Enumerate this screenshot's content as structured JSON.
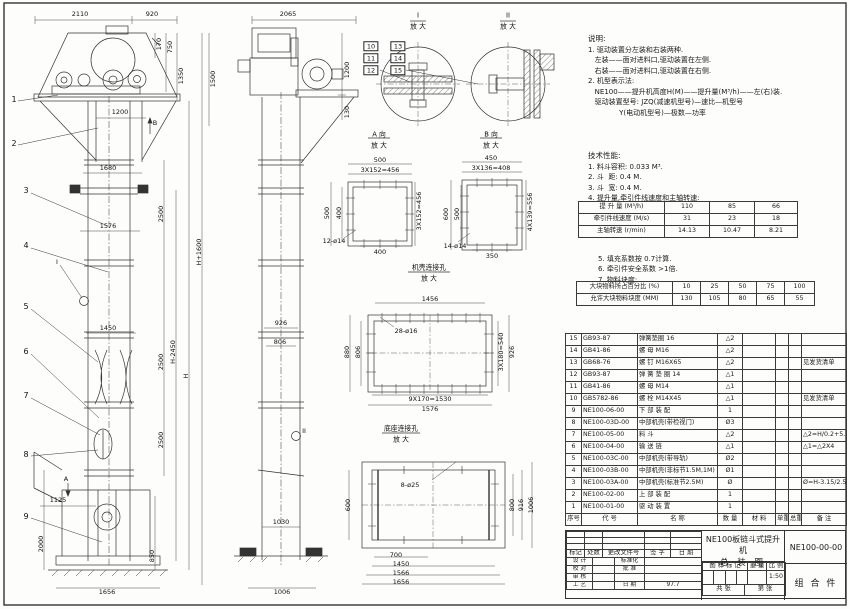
{
  "doc": {
    "type": "engineering-assembly-drawing",
    "product": "NE100板链斗式提升机",
    "drawing_title_line1": "NE100板链斗式提升机",
    "drawing_title_line2": "总  装  图",
    "drawing_number": "NE100-00-00",
    "part_class": "组 合 件",
    "scale": "1:50",
    "date": "97.7"
  },
  "notes": {
    "title": "说明:",
    "lines": [
      "1. 驱动装置分左装和右装两种.",
      "   左装——面对进料口,驱动装置在左侧.",
      "   右装——面对进料口,驱动装置在右侧.",
      "2. 机型表示法:",
      "   NE100——提升机高度H(M)——提升量(M³/h)——左(右)装.",
      "   驱动装置型号: JZQ(减速机型号)—速比—机型号",
      "              Y(电动机型号)—极数—功率"
    ]
  },
  "tech": {
    "title": "技术性能:",
    "lines": [
      "1. 料斗容积: 0.033 M³.",
      "2. 斗  距: 0.4 M.",
      "3. 斗  宽: 0.4 M.",
      "4. 提升量,牵引件线速度和主轴转速:"
    ],
    "notes2": [
      "5. 填充系数按 0.7计算.",
      "6. 牵引件安全系数 >1倍.",
      "7. 物料块度:"
    ]
  },
  "perf_table": {
    "rows": [
      [
        "提 升 量  (M³/h)",
        "110",
        "85",
        "66"
      ],
      [
        "牵引件线速度 (M/s)",
        "31",
        "23",
        "18"
      ],
      [
        "主轴转速 (r/min)",
        "14.13",
        "10.47",
        "8.21"
      ]
    ]
  },
  "lump_table": {
    "rows": [
      [
        "大块物料所占百分比 (%)",
        "10",
        "25",
        "50",
        "75",
        "100"
      ],
      [
        "允许大块物料块度 (MM)",
        "130",
        "105",
        "80",
        "65",
        "55"
      ]
    ]
  },
  "bom": {
    "headers": [
      "序号",
      "代  号",
      "名  称",
      "数 量",
      "材  料",
      "单重",
      "总重",
      "备  注"
    ],
    "rows": [
      [
        "15",
        "GB93-87",
        "弹簧垫圈  16",
        "△2",
        "",
        "",
        "",
        ""
      ],
      [
        "14",
        "GB41-86",
        "螺  母  M16",
        "△2",
        "",
        "",
        "",
        ""
      ],
      [
        "13",
        "GB68-76",
        "螺  钉  M16X65",
        "△2",
        "",
        "",
        "",
        "见发货清单"
      ],
      [
        "12",
        "GB93-87",
        "弹 簧 垫 圈  14",
        "△1",
        "",
        "",
        "",
        ""
      ],
      [
        "11",
        "GB41-86",
        "螺  母  M14",
        "△1",
        "",
        "",
        "",
        ""
      ],
      [
        "10",
        "GB5782-86",
        "螺  栓  M14X45",
        "△1",
        "",
        "",
        "",
        "见发货清单"
      ],
      [
        "9",
        "NE100-06-00",
        "下 部 装 配",
        "1",
        "",
        "",
        "",
        ""
      ],
      [
        "8",
        "NE100-03D-00",
        "中部机壳(带检视门)",
        "Ø3",
        "",
        "",
        "",
        ""
      ],
      [
        "7",
        "NE100-05-00",
        "料  斗",
        "△2",
        "",
        "",
        "",
        "△2=H/0.2+5.75"
      ],
      [
        "6",
        "NE100-04-00",
        "输 送 链",
        "△1",
        "",
        "",
        "",
        "△1=△2X4"
      ],
      [
        "5",
        "NE100-03C-00",
        "中部机壳(带导轨)",
        "Ø2",
        "",
        "",
        "",
        ""
      ],
      [
        "4",
        "NE100-03B-00",
        "中部机壳(非标节1.5M,1M)",
        "Ø1",
        "",
        "",
        "",
        ""
      ],
      [
        "3",
        "NE100-03A-00",
        "中部机壳(标准节2.5M)",
        "Ø",
        "",
        "",
        "",
        "Ø=H-3.15/2.5"
      ],
      [
        "2",
        "NE100-02-00",
        "上 部 装 配",
        "1",
        "",
        "",
        "",
        ""
      ],
      [
        "1",
        "NE100-01-00",
        "驱 动 装 置",
        "1",
        "",
        "",
        "",
        ""
      ]
    ]
  },
  "title_block": {
    "change_header": [
      "标记",
      "处数",
      "更改文件号",
      "签 字",
      "日 期"
    ],
    "sign_rows": [
      [
        "设 计",
        "",
        "标准化",
        ""
      ],
      [
        "校 对",
        "",
        "批 准",
        ""
      ],
      [
        "审 核",
        "",
        "",
        ""
      ],
      [
        "工 艺",
        "",
        "日 期",
        "97.7"
      ]
    ],
    "mark_header": [
      "图 样 标 记",
      "重 量",
      "比 例"
    ],
    "scale_value": "1:50",
    "sheet_left": "共  张",
    "sheet_right": "第  张"
  },
  "view_titles": {
    "detail1": "I",
    "detail2": "II",
    "enlarge": "放 大",
    "viewA": "A 向",
    "viewB": "B 向",
    "casing_holes": "机壳连接孔",
    "base_holes": "底座连接孔"
  },
  "labels": [
    {
      "t": "2110",
      "x": 80,
      "y": 14
    },
    {
      "t": "920",
      "x": 152,
      "y": 14
    },
    {
      "t": "170",
      "x": 159,
      "y": 44,
      "c": "v"
    },
    {
      "t": "750",
      "x": 170,
      "y": 47,
      "c": "v"
    },
    {
      "t": "1350",
      "x": 181,
      "y": 76,
      "c": "v"
    },
    {
      "t": "1500",
      "x": 213,
      "y": 79,
      "c": "v"
    },
    {
      "t": "1200",
      "x": 120,
      "y": 112
    },
    {
      "t": "B",
      "x": 155,
      "y": 123
    },
    {
      "t": "1680",
      "x": 108,
      "y": 168
    },
    {
      "t": "1576",
      "x": 108,
      "y": 226
    },
    {
      "t": "2500",
      "x": 161,
      "y": 214,
      "c": "v"
    },
    {
      "t": "2500",
      "x": 161,
      "y": 362,
      "c": "v"
    },
    {
      "t": "2500",
      "x": 161,
      "y": 440,
      "c": "v"
    },
    {
      "t": "H-2450",
      "x": 173,
      "y": 352,
      "c": "v"
    },
    {
      "t": "H",
      "x": 186,
      "y": 376,
      "c": "v"
    },
    {
      "t": "H+1600",
      "x": 199,
      "y": 252,
      "c": "v"
    },
    {
      "t": "1450",
      "x": 108,
      "y": 328
    },
    {
      "t": "1125",
      "x": 58,
      "y": 500
    },
    {
      "t": "2000",
      "x": 41,
      "y": 544,
      "c": "v"
    },
    {
      "t": "850",
      "x": 152,
      "y": 556,
      "c": "v"
    },
    {
      "t": "A",
      "x": 66,
      "y": 479
    },
    {
      "t": "1656",
      "x": 107,
      "y": 592
    },
    {
      "t": "I",
      "x": 57,
      "y": 262
    },
    {
      "t": "II",
      "x": 304,
      "y": 431
    },
    {
      "t": "2065",
      "x": 288,
      "y": 14
    },
    {
      "t": "1200",
      "x": 347,
      "y": 70,
      "c": "v"
    },
    {
      "t": "130",
      "x": 347,
      "y": 112,
      "c": "v"
    },
    {
      "t": "926",
      "x": 281,
      "y": 323
    },
    {
      "t": "806",
      "x": 280,
      "y": 342
    },
    {
      "t": "1030",
      "x": 281,
      "y": 522
    },
    {
      "t": "1006",
      "x": 282,
      "y": 592
    },
    {
      "t": "500",
      "x": 380,
      "y": 160
    },
    {
      "t": "3X152=456",
      "x": 380,
      "y": 170
    },
    {
      "t": "500",
      "x": 327,
      "y": 213,
      "c": "v"
    },
    {
      "t": "400",
      "x": 339,
      "y": 213,
      "c": "v"
    },
    {
      "t": "3X152=456",
      "x": 419,
      "y": 211,
      "c": "v"
    },
    {
      "t": "12-ø14",
      "x": 334,
      "y": 241
    },
    {
      "t": "400",
      "x": 380,
      "y": 252
    },
    {
      "t": "450",
      "x": 491,
      "y": 158
    },
    {
      "t": "3X136=408",
      "x": 491,
      "y": 168
    },
    {
      "t": "600",
      "x": 446,
      "y": 214,
      "c": "v"
    },
    {
      "t": "500",
      "x": 457,
      "y": 214,
      "c": "v"
    },
    {
      "t": "4X139=556",
      "x": 530,
      "y": 212,
      "c": "v"
    },
    {
      "t": "14-ø14",
      "x": 455,
      "y": 246
    },
    {
      "t": "350",
      "x": 492,
      "y": 256
    },
    {
      "t": "1456",
      "x": 430,
      "y": 299
    },
    {
      "t": "28-ø16",
      "x": 406,
      "y": 331
    },
    {
      "t": "880",
      "x": 347,
      "y": 352,
      "c": "v"
    },
    {
      "t": "806",
      "x": 358,
      "y": 352,
      "c": "v"
    },
    {
      "t": "3X180=540",
      "x": 501,
      "y": 352,
      "c": "v"
    },
    {
      "t": "926",
      "x": 512,
      "y": 352,
      "c": "v"
    },
    {
      "t": "9X170=1530",
      "x": 430,
      "y": 399
    },
    {
      "t": "1576",
      "x": 430,
      "y": 409
    },
    {
      "t": "8-ø25",
      "x": 410,
      "y": 485
    },
    {
      "t": "600",
      "x": 348,
      "y": 505,
      "c": "v"
    },
    {
      "t": "800",
      "x": 512,
      "y": 505,
      "c": "v"
    },
    {
      "t": "916",
      "x": 521,
      "y": 505,
      "c": "v"
    },
    {
      "t": "1006",
      "x": 531,
      "y": 505,
      "c": "v"
    },
    {
      "t": "700",
      "x": 396,
      "y": 555
    },
    {
      "t": "1450",
      "x": 401,
      "y": 564
    },
    {
      "t": "1566",
      "x": 401,
      "y": 573
    },
    {
      "t": "1656",
      "x": 401,
      "y": 582
    },
    {
      "t": "I",
      "x": 418,
      "y": 16,
      "c": "vt"
    },
    {
      "t": "放 大",
      "x": 418,
      "y": 27,
      "c": "vt"
    },
    {
      "t": "II",
      "x": 508,
      "y": 16,
      "c": "vt"
    },
    {
      "t": "放 大",
      "x": 508,
      "y": 27,
      "c": "vt"
    },
    {
      "t": "A 向",
      "x": 379,
      "y": 135,
      "c": "vt"
    },
    {
      "t": "放 大",
      "x": 379,
      "y": 146,
      "c": "vt"
    },
    {
      "t": "B 向",
      "x": 491,
      "y": 135,
      "c": "vt"
    },
    {
      "t": "放 大",
      "x": 491,
      "y": 146,
      "c": "vt"
    },
    {
      "t": "机壳连接孔",
      "x": 429,
      "y": 268,
      "c": "vt"
    },
    {
      "t": "放 大",
      "x": 429,
      "y": 279,
      "c": "vt"
    },
    {
      "t": "底座连接孔",
      "x": 401,
      "y": 429,
      "c": "vt"
    },
    {
      "t": "放 大",
      "x": 401,
      "y": 440,
      "c": "vt"
    }
  ],
  "balloons": [
    {
      "n": "1",
      "x": 14,
      "y": 100
    },
    {
      "n": "2",
      "x": 14,
      "y": 144
    },
    {
      "n": "3",
      "x": 26,
      "y": 191
    },
    {
      "n": "4",
      "x": 26,
      "y": 246
    },
    {
      "n": "5",
      "x": 26,
      "y": 307
    },
    {
      "n": "6",
      "x": 26,
      "y": 352
    },
    {
      "n": "7",
      "x": 26,
      "y": 396
    },
    {
      "n": "8",
      "x": 26,
      "y": 455
    },
    {
      "n": "9",
      "x": 26,
      "y": 517
    },
    {
      "n": "10",
      "x": 371,
      "y": 46,
      "b": 1
    },
    {
      "n": "11",
      "x": 371,
      "y": 58,
      "b": 1
    },
    {
      "n": "12",
      "x": 371,
      "y": 70,
      "b": 1
    },
    {
      "n": "13",
      "x": 398,
      "y": 46,
      "b": 1
    },
    {
      "n": "14",
      "x": 398,
      "y": 58,
      "b": 1
    },
    {
      "n": "15",
      "x": 398,
      "y": 70,
      "b": 1
    }
  ]
}
